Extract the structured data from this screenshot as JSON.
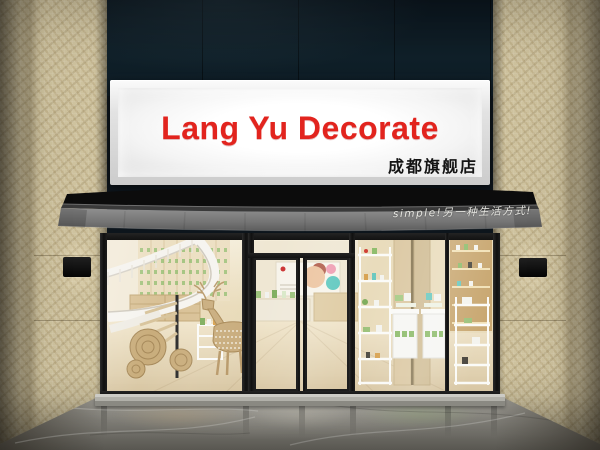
{
  "scene": {
    "caption": "3D render of a cosmetics shop storefront with illuminated sign, black awning, glass facade, spiral staircase and product displays",
    "signboard": {
      "title": "Lang Yu Decorate",
      "title_color": "#e2241e",
      "subtitle": "成都旗舰店",
      "subtitle_color": "#141414",
      "panel_color": "#f6f6f6"
    },
    "awning": {
      "slogan": "simple!另一种生活方式!",
      "slogan_color": "#f0efe9",
      "canopy_color": "#0c0c0c",
      "valance_color": "#6f6f6f"
    },
    "palette": {
      "fascia_dark": "#0f1f29",
      "wall_tile": "#cec29e",
      "frame_black": "#181818",
      "interior_wall": "#ecdfc2",
      "interior_wood": "#c9a872",
      "product_green": "#8fbd6d",
      "floor_marble": "#86847e"
    }
  }
}
